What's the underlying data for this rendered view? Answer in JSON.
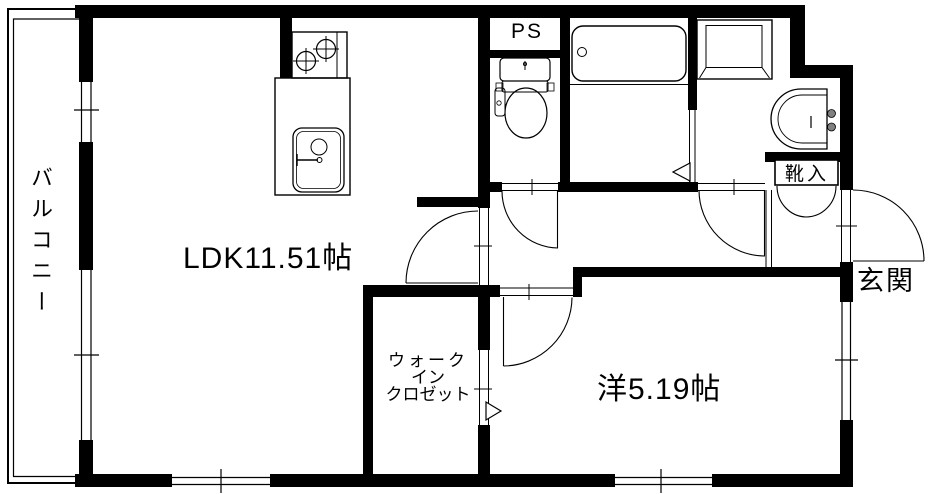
{
  "page": {
    "type": "apartment-floor-plan",
    "background": "#ffffff"
  },
  "colors": {
    "walls": "#000000",
    "lines": "#000000",
    "faucet_knobs": "#808080"
  },
  "rooms": {
    "balcony": {
      "label": "バルコニー"
    },
    "ldk": {
      "label": "LDK11.51帖"
    },
    "pipe_space": {
      "label": "PS"
    },
    "walk_in_closet": {
      "line1": "ウォーク",
      "line2": "イン",
      "line3": "クロゼット"
    },
    "bedroom": {
      "label": "洋5.19帖"
    },
    "shoe_cabinet": {
      "label": "靴入"
    },
    "entrance": {
      "label": "玄関"
    }
  },
  "fixtures": {
    "kitchen_stove": "gas-stove-icon",
    "kitchen_sink": "kitchen-sink-icon",
    "toilet": "toilet-icon",
    "bathtub": "bathtub-icon",
    "washing_machine_pan": "washer-pan-icon",
    "washbasin": "washbasin-icon"
  }
}
